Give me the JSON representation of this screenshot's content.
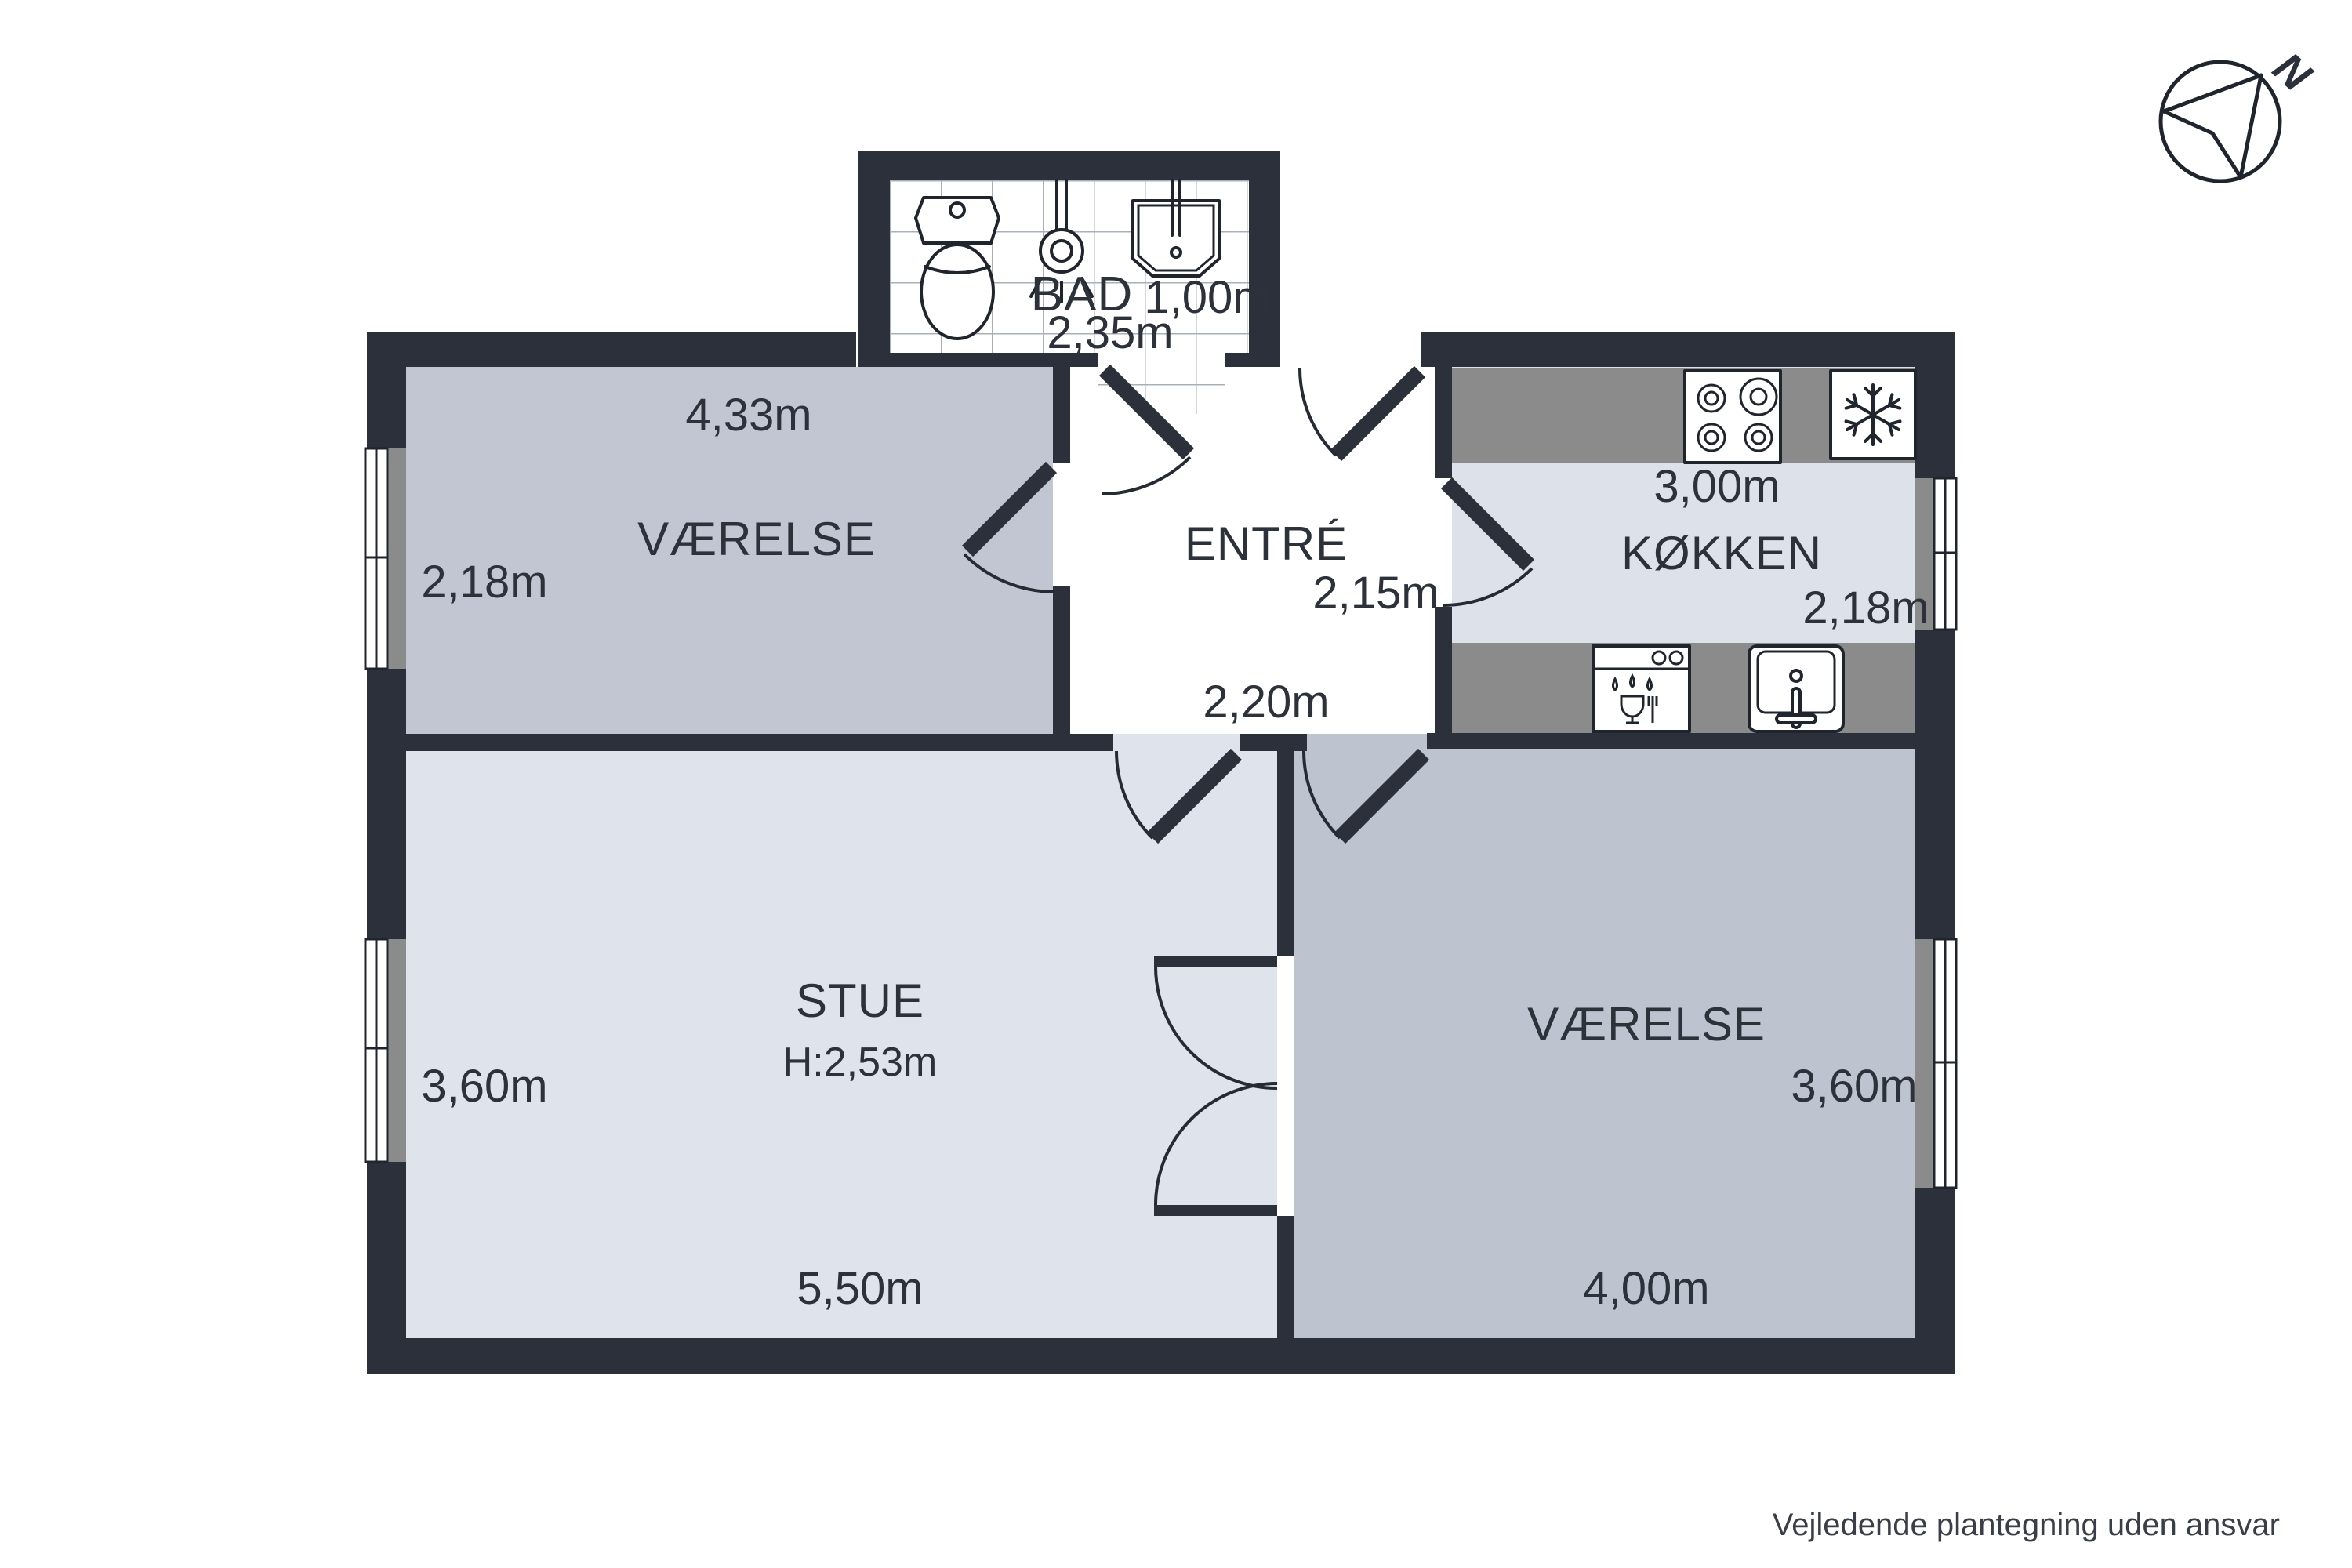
{
  "plan": {
    "disclaimer": "Vejledende plantegning uden ansvar",
    "compass": {
      "north_label": "N"
    },
    "rooms": {
      "bad": {
        "name": "BAD",
        "width": "2,35m",
        "depth": "1,00m"
      },
      "vaerelse1": {
        "name": "VÆRELSE",
        "width": "4,33m",
        "depth": "2,18m"
      },
      "entre": {
        "name": "ENTRÉ",
        "width": "2,20m",
        "depth": "2,15m"
      },
      "koekken": {
        "name": "KØKKEN",
        "width": "3,00m",
        "depth": "2,18m"
      },
      "stue": {
        "name": "STUE",
        "ceiling_height": "H:2,53m",
        "width": "5,50m",
        "depth": "3,60m"
      },
      "vaerelse2": {
        "name": "VÆRELSE",
        "width": "4,00m",
        "depth": "3,60m"
      }
    },
    "icons": [
      "toilet-icon",
      "shower-icon",
      "bath-sink-icon",
      "stove-icon",
      "fridge-snowflake-icon",
      "dishwasher-icon",
      "kitchen-sink-icon",
      "north-arrow-icon"
    ],
    "colors": {
      "wall": "#2b303a",
      "room_vaerelse1_floor": "#c1c6d2",
      "room_vaerelse2_floor": "#bdc3cf",
      "room_stue_floor": "#dfe3ec",
      "room_kitchen_floor": "#dce1ea",
      "counter": "#8b8b8b",
      "text": "#2c313a",
      "background": "#ffffff"
    }
  }
}
